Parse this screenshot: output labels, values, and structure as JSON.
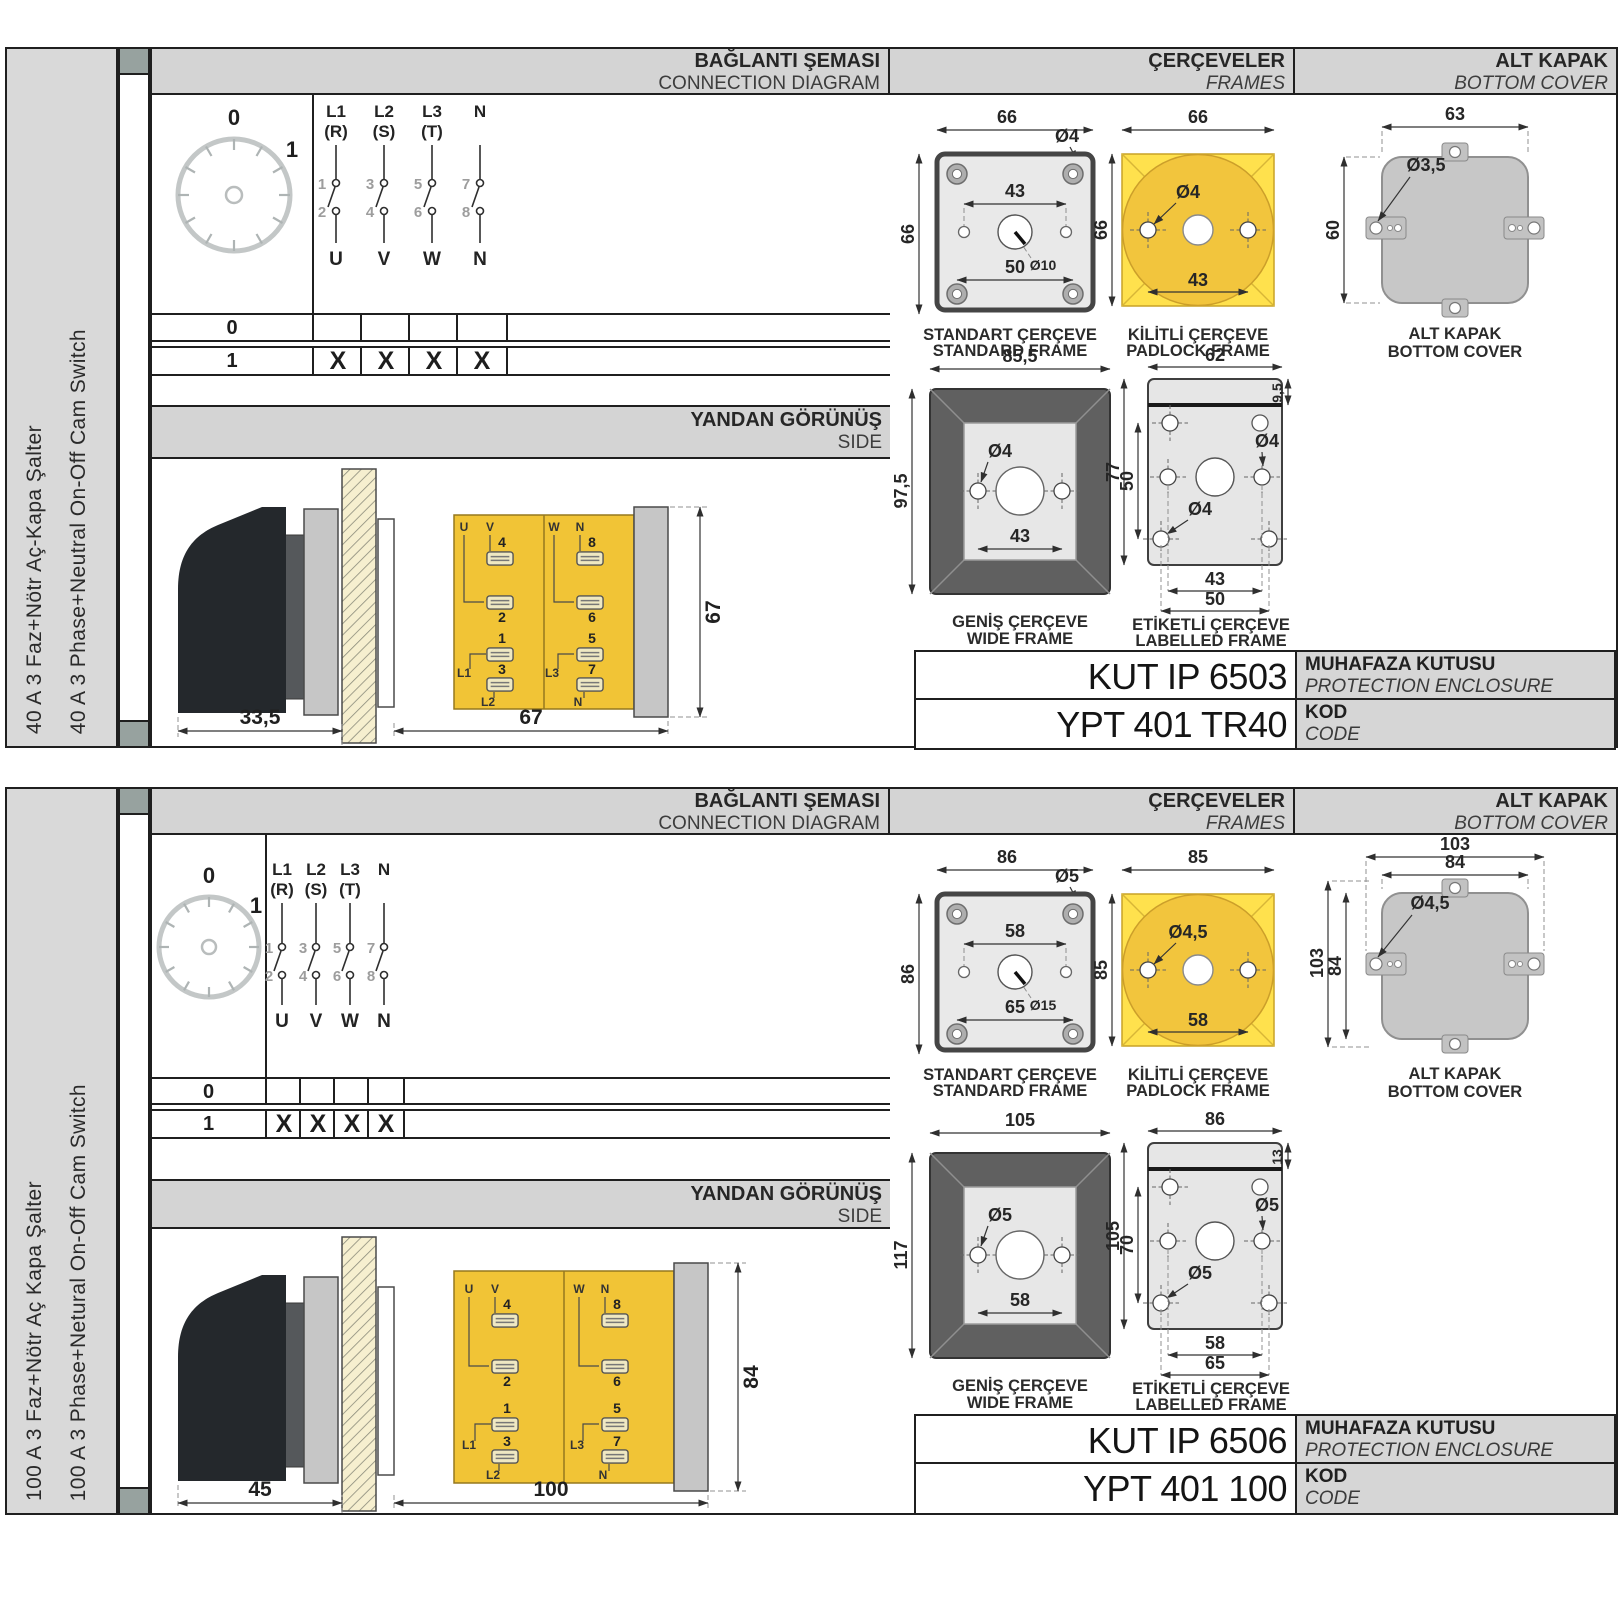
{
  "palette": {
    "panel_gray": "#d9d9d9",
    "header_gray": "#d4d4d4",
    "spine_cap": "#97a29f",
    "yellow": "#f5ce3e",
    "yellow_deep": "#f2c53d",
    "frame_dark": "#5f5f5f",
    "cover_gray": "#c7c7c7",
    "border": "#1f1f1f"
  },
  "sections": [
    {
      "sidebar": {
        "tr": "40 A 3 Faz+Nötr Aç-Kapa Şalter",
        "en": "40 A 3 Phase+Neutral On-Off Cam Switch"
      },
      "headers": {
        "diagram_tr": "BAĞLANTI ŞEMASI",
        "diagram_en": "CONNECTION DIAGRAM",
        "frames_tr": "ÇERÇEVELER",
        "frames_en": "FRAMES",
        "cover_tr": "ALT KAPAK",
        "cover_en": "BOTTOM COVER",
        "side_tr": "YANDAN GÖRÜNÜŞ",
        "side_en": "SIDE"
      },
      "dial": {
        "pos0": "0",
        "pos1": "1"
      },
      "poles": [
        {
          "l": "L1",
          "r": "(R)",
          "a": "1",
          "b": "2",
          "out": "U"
        },
        {
          "l": "L2",
          "r": "(S)",
          "a": "3",
          "b": "4",
          "out": "V"
        },
        {
          "l": "L3",
          "r": "(T)",
          "a": "5",
          "b": "6",
          "out": "W"
        },
        {
          "l": "N",
          "r": "",
          "a": "7",
          "b": "8",
          "out": "N"
        }
      ],
      "table": {
        "row0": "0",
        "row1": "1",
        "x1": "X",
        "x2": "X",
        "x3": "X",
        "x4": "X"
      },
      "side": {
        "dim_front": "33,5",
        "dim_body": "67",
        "dim_height": "67",
        "u": "U",
        "v": "V",
        "wl": "W",
        "n_top": "N",
        "t4": "4",
        "t2": "2",
        "t1": "1",
        "t3": "3",
        "t8": "8",
        "t6": "6",
        "t5": "5",
        "t7": "7",
        "l1": "L1",
        "l2": "L2",
        "l3": "L3",
        "n_bot": "N"
      },
      "standard": {
        "title_tr": "STANDART ÇERÇEVE",
        "title_en": "STANDARD FRAME",
        "w": "66",
        "h": "66",
        "hole": "Ø4",
        "inner": "43",
        "center": "Ø10",
        "outer": "50"
      },
      "padlock": {
        "title_tr": "KİLİTLİ ÇERÇEVE",
        "title_en": "PADLOCK FRAME",
        "w": "66",
        "h": "66",
        "hole": "Ø4",
        "inner": "43"
      },
      "wide": {
        "title_tr": "GENİŞ ÇERÇEVE",
        "title_en": "WIDE FRAME",
        "w": "85,5",
        "h": "97,5",
        "hole": "Ø4",
        "inner": "43"
      },
      "labelled": {
        "title_tr": "ETİKETLİ ÇERÇEVE",
        "title_en": "LABELLED FRAME",
        "w": "62",
        "band": "9,5",
        "h": "77",
        "rows": "50",
        "hole_r": "Ø4",
        "hole_b": "Ø4",
        "inner": "43",
        "outer": "50"
      },
      "cover": {
        "w": "63",
        "h": "60",
        "hole": "Ø3,5",
        "label_tr": "ALT KAPAK",
        "label_en": "BOTTOM COVER"
      },
      "enclosure": {
        "code": "KUT IP 6503",
        "label_tr": "MUHAFAZA KUTUSU",
        "label_en": "PROTECTION ENCLOSURE"
      },
      "code": {
        "value": "YPT 401 TR40",
        "label_tr": "KOD",
        "label_en": "CODE"
      }
    },
    {
      "sidebar": {
        "tr": "100 A 3 Faz+Nötr Aç Kapa Şalter",
        "en": "100 A 3 Phase+Netural On-Off Cam Switch"
      },
      "headers": {
        "diagram_tr": "BAĞLANTI ŞEMASI",
        "diagram_en": "CONNECTION DIAGRAM",
        "frames_tr": "ÇERÇEVELER",
        "frames_en": "FRAMES",
        "cover_tr": "ALT KAPAK",
        "cover_en": "BOTTOM COVER",
        "side_tr": "YANDAN GÖRÜNÜŞ",
        "side_en": "SIDE"
      },
      "dial": {
        "pos0": "0",
        "pos1": "1"
      },
      "poles": [
        {
          "l": "L1",
          "r": "(R)",
          "a": "1",
          "b": "2",
          "out": "U"
        },
        {
          "l": "L2",
          "r": "(S)",
          "a": "3",
          "b": "4",
          "out": "V"
        },
        {
          "l": "L3",
          "r": "(T)",
          "a": "5",
          "b": "6",
          "out": "W"
        },
        {
          "l": "N",
          "r": "",
          "a": "7",
          "b": "8",
          "out": "N"
        }
      ],
      "table": {
        "row0": "0",
        "row1": "1",
        "x1": "X",
        "x2": "X",
        "x3": "X",
        "x4": "X"
      },
      "side": {
        "dim_front": "45",
        "dim_body": "100",
        "dim_height": "84",
        "u": "U",
        "v": "V",
        "wl": "W",
        "n_top": "N",
        "t4": "4",
        "t2": "2",
        "t1": "1",
        "t3": "3",
        "t8": "8",
        "t6": "6",
        "t5": "5",
        "t7": "7",
        "l1": "L1",
        "l2": "L2",
        "l3": "L3",
        "n_bot": "N"
      },
      "standard": {
        "title_tr": "STANDART ÇERÇEVE",
        "title_en": "STANDARD FRAME",
        "w": "86",
        "h": "86",
        "hole": "Ø5",
        "inner": "58",
        "center": "Ø15",
        "outer": "65"
      },
      "padlock": {
        "title_tr": "KİLİTLİ ÇERÇEVE",
        "title_en": "PADLOCK FRAME",
        "w": "85",
        "h": "85",
        "hole": "Ø4,5",
        "inner": "58"
      },
      "wide": {
        "title_tr": "GENİŞ ÇERÇEVE",
        "title_en": "WIDE FRAME",
        "w": "105",
        "h": "117",
        "hole": "Ø5",
        "inner": "58"
      },
      "labelled": {
        "title_tr": "ETİKETLİ ÇERÇEVE",
        "title_en": "LABELLED FRAME",
        "w": "86",
        "band": "13",
        "h": "105",
        "rows": "70",
        "hole_r": "Ø5",
        "hole_b": "Ø5",
        "inner": "58",
        "outer": "65"
      },
      "cover": {
        "w_outer": "103",
        "w_inner": "84",
        "h_outer": "103",
        "h_inner": "84",
        "hole": "Ø4,5",
        "label_tr": "ALT KAPAK",
        "label_en": "BOTTOM COVER"
      },
      "enclosure": {
        "code": "KUT IP 6506",
        "label_tr": "MUHAFAZA KUTUSU",
        "label_en": "PROTECTION ENCLOSURE"
      },
      "code": {
        "value": "YPT 401 100",
        "label_tr": "KOD",
        "label_en": "CODE"
      }
    }
  ]
}
